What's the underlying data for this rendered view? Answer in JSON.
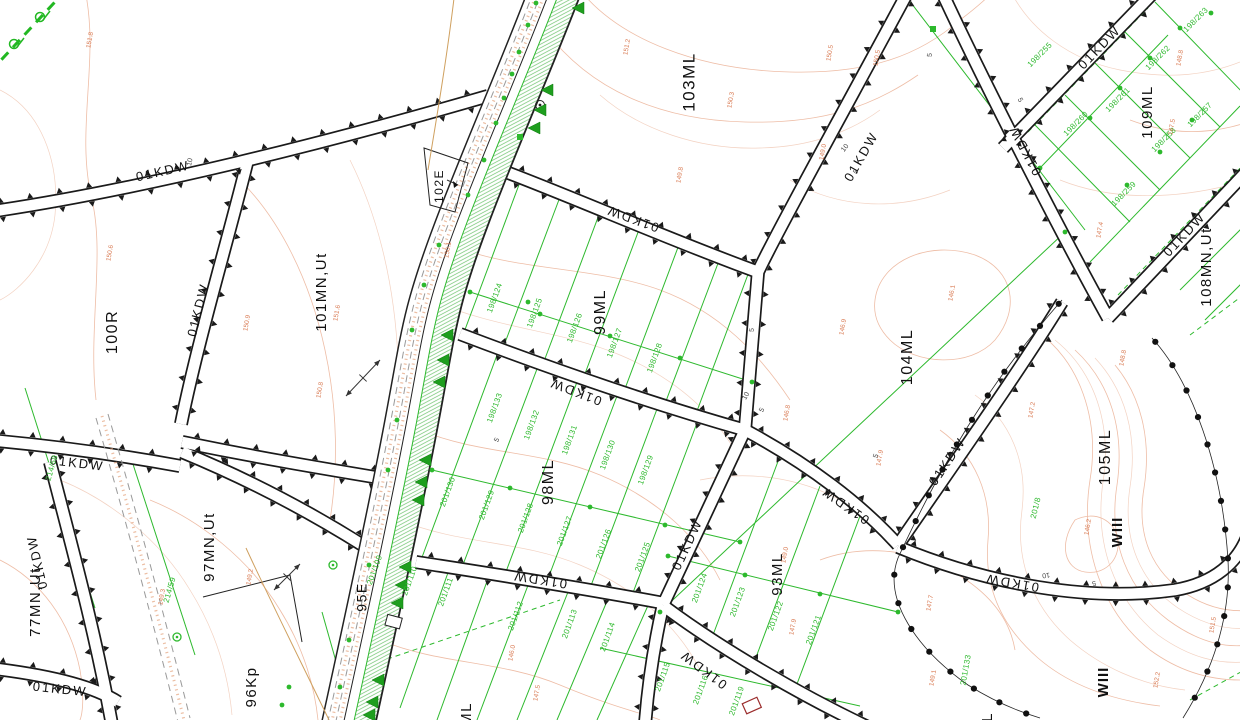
{
  "map": {
    "colors": {
      "road_line": "#1a1a1a",
      "road_fill": "#ffffff",
      "parcel_text": "#111111",
      "green": "#2db92d",
      "hatch_green": "#6cc26c",
      "contour_line": "#eebda6",
      "contour_text": "#d97a52",
      "dim_text": "#444444",
      "boundary_dot": "#111111",
      "building": "#9b2c2c"
    },
    "labels": {
      "parcels": [
        [
          "100R",
          113,
          332,
          16
        ],
        [
          "101MN,Ut",
          322,
          292,
          15
        ],
        [
          "102E",
          440,
          186,
          12
        ],
        [
          "103ML",
          690,
          82,
          17
        ],
        [
          "99ML",
          601,
          312,
          16
        ],
        [
          "98ML",
          549,
          482,
          16
        ],
        [
          "104ML",
          908,
          357,
          16
        ],
        [
          "93ML",
          778,
          574,
          15
        ],
        [
          "95E",
          363,
          597,
          14
        ],
        [
          "96Kp",
          252,
          687,
          15
        ],
        [
          "97MN,Ut",
          210,
          547,
          15
        ],
        [
          "77MN,Ut",
          36,
          602,
          15
        ],
        [
          "105ML",
          1106,
          457,
          16
        ],
        [
          "108MN,Ut",
          1207,
          267,
          15
        ],
        [
          "109ML",
          1148,
          112,
          15
        ],
        [
          "ML",
          467,
          714,
          15
        ],
        [
          "ML",
          988,
          724,
          15
        ]
      ],
      "zones": [
        [
          "WIII",
          1118,
          532
        ],
        [
          "WIII",
          1104,
          682
        ]
      ],
      "roads": [
        [
          "01KDW",
          163,
          172,
          -13
        ],
        [
          "01KDW",
          199,
          310,
          -76
        ],
        [
          "01KDW",
          862,
          157,
          -60
        ],
        [
          "01KDW",
          633,
          218,
          200
        ],
        [
          "01KDW",
          576,
          391,
          201
        ],
        [
          "01KDW",
          540,
          579,
          189
        ],
        [
          "01KDW",
          77,
          464,
          7
        ],
        [
          "01KDW",
          38,
          562,
          -103
        ],
        [
          "01KDW",
          60,
          690,
          6
        ],
        [
          "01KDW",
          704,
          669,
          217
        ],
        [
          "01KDW",
          846,
          505,
          215
        ],
        [
          "01KDW",
          688,
          545,
          -65
        ],
        [
          "01KDW",
          948,
          462,
          -56
        ],
        [
          "01KDW",
          1012,
          582,
          190
        ],
        [
          "01KDW",
          1100,
          48,
          -46
        ],
        [
          "01KDW",
          1026,
          150,
          -118
        ],
        [
          "01KDW",
          1185,
          235,
          -47
        ]
      ],
      "parcel_numbers": [
        [
          "198/124",
          495,
          298,
          -70
        ],
        [
          "198/125",
          535,
          313,
          -70
        ],
        [
          "198/126",
          575,
          328,
          -70
        ],
        [
          "198/127",
          615,
          343,
          -70
        ],
        [
          "198/128",
          655,
          358,
          -70
        ],
        [
          "198/133",
          495,
          408,
          -70
        ],
        [
          "198/132",
          532,
          425,
          -70
        ],
        [
          "198/131",
          570,
          440,
          -70
        ],
        [
          "198/130",
          608,
          455,
          -70
        ],
        [
          "198/129",
          646,
          470,
          -70
        ],
        [
          "201/130",
          448,
          492,
          -70
        ],
        [
          "201/129",
          487,
          505,
          -70
        ],
        [
          "201/128",
          526,
          518,
          -70
        ],
        [
          "201/127",
          565,
          531,
          -70
        ],
        [
          "201/126",
          604,
          544,
          -70
        ],
        [
          "201/125",
          643,
          557,
          -70
        ],
        [
          "201/124",
          700,
          588,
          -70
        ],
        [
          "201/123",
          738,
          602,
          -70
        ],
        [
          "201/122",
          776,
          616,
          -70
        ],
        [
          "201/121",
          814,
          630,
          -70
        ],
        [
          "201/113",
          570,
          624,
          -70
        ],
        [
          "201/114",
          608,
          637,
          -70
        ],
        [
          "201/115",
          663,
          677,
          -70
        ],
        [
          "201/116",
          701,
          690,
          -70
        ],
        [
          "201/119",
          737,
          701,
          -70
        ],
        [
          "201/109",
          375,
          570,
          -70
        ],
        [
          "201/110",
          410,
          581,
          -70
        ],
        [
          "201/111",
          446,
          592,
          -70
        ],
        [
          "201/112",
          516,
          616,
          -70
        ],
        [
          "214/58",
          52,
          468,
          -74
        ],
        [
          "214/59",
          170,
          590,
          -74
        ],
        [
          "198/255",
          1040,
          55,
          -45
        ],
        [
          "198/260",
          1076,
          124,
          -45
        ],
        [
          "198/261",
          1118,
          100,
          -45
        ],
        [
          "198/262",
          1158,
          58,
          -45
        ],
        [
          "198/263",
          1196,
          20,
          -45
        ],
        [
          "198/257",
          1200,
          115,
          -45
        ],
        [
          "198/258",
          1164,
          140,
          -45
        ],
        [
          "198/259",
          1124,
          194,
          -45
        ],
        [
          "201/8",
          1036,
          508,
          -76
        ],
        [
          "201/133",
          966,
          670,
          -80
        ]
      ],
      "contours": [
        [
          "151.8",
          90,
          40
        ],
        [
          "151.2",
          627,
          47
        ],
        [
          "150.5",
          830,
          53
        ],
        [
          "150.5",
          877,
          58
        ],
        [
          "150.3",
          731,
          100
        ],
        [
          "149.0",
          823,
          152
        ],
        [
          "149.8",
          680,
          175
        ],
        [
          "150.6",
          110,
          253
        ],
        [
          "150.1",
          448,
          250
        ],
        [
          "150.9",
          247,
          323
        ],
        [
          "151.6",
          337,
          313
        ],
        [
          "150.8",
          320,
          390
        ],
        [
          "146.8",
          787,
          413
        ],
        [
          "146.9",
          843,
          327
        ],
        [
          "146.1",
          952,
          293
        ],
        [
          "147.2",
          1032,
          410
        ],
        [
          "146.2",
          1088,
          527
        ],
        [
          "148.8",
          1123,
          358
        ],
        [
          "146.0",
          512,
          653
        ],
        [
          "147.5",
          537,
          693
        ],
        [
          "149.2",
          250,
          577
        ],
        [
          "149.3",
          162,
          597
        ],
        [
          "149.0",
          785,
          555
        ],
        [
          "147.9",
          793,
          627
        ],
        [
          "147.7",
          930,
          603
        ],
        [
          "151.5",
          1213,
          625
        ],
        [
          "152.2",
          1157,
          680
        ],
        [
          "149.1",
          933,
          678
        ],
        [
          "148.8",
          1180,
          58
        ],
        [
          "147.5",
          1172,
          127
        ],
        [
          "147.4",
          1100,
          230
        ],
        [
          "147.9",
          880,
          458
        ]
      ],
      "dimensions": [
        [
          "10",
          190,
          162,
          -78
        ],
        [
          "10",
          845,
          148,
          -52
        ],
        [
          "5",
          856,
          172,
          -52
        ],
        [
          "5",
          930,
          55,
          -85
        ],
        [
          "5",
          1020,
          100,
          63
        ],
        [
          "10",
          746,
          396,
          -62
        ],
        [
          "5",
          762,
          410,
          -62
        ],
        [
          "5",
          876,
          456,
          -70
        ],
        [
          "5",
          497,
          440,
          -62
        ],
        [
          "10",
          1046,
          575,
          172
        ],
        [
          "5",
          1094,
          583,
          172
        ],
        [
          "5",
          752,
          330,
          -85
        ]
      ]
    }
  }
}
